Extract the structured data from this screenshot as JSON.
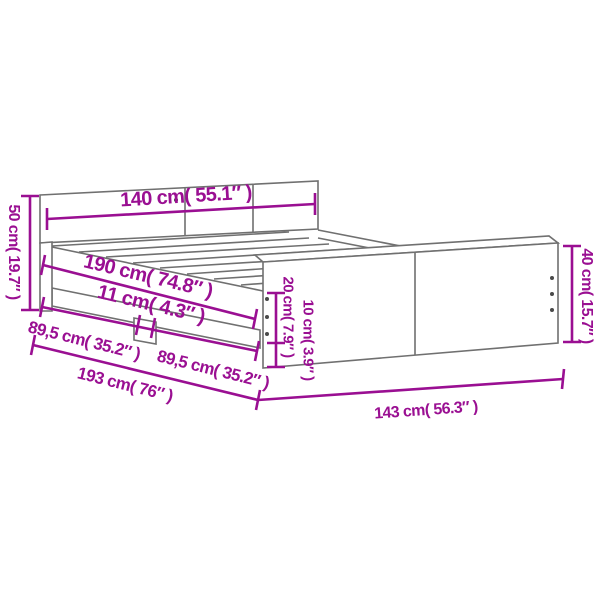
{
  "title": "Bed frame dimensions diagram",
  "colors": {
    "dimension_accent": "#9A0F92",
    "line_art": "#707070",
    "background": "#FFFFFF"
  },
  "diagram": {
    "kind": "furniture-dimension-drawing",
    "parts": [
      "headboard",
      "slatted-base",
      "side-rail",
      "center-leg",
      "footboard"
    ]
  },
  "dimensions": [
    {
      "id": "inner-width",
      "label": "140 cm( 55.1″ )",
      "cm": "140",
      "inches": "55.1"
    },
    {
      "id": "headboard-height",
      "label": "50 cm( 19.7″ )",
      "cm": "50",
      "inches": "19.7"
    },
    {
      "id": "inner-length",
      "label": "190 cm( 74.8″ )",
      "cm": "190",
      "inches": "74.8"
    },
    {
      "id": "center-leg-width",
      "label": "11 cm( 4.3″ )",
      "cm": "11",
      "inches": "4.3"
    },
    {
      "id": "half-length-left",
      "label": "89,5 cm( 35.2″ )",
      "cm": "89,5",
      "inches": "35.2"
    },
    {
      "id": "half-length-right",
      "label": "89,5 cm( 35.2″ )",
      "cm": "89,5",
      "inches": "35.2"
    },
    {
      "id": "total-length",
      "label": "193 cm( 76″ )",
      "cm": "193",
      "inches": "76"
    },
    {
      "id": "total-width",
      "label": "143 cm( 56.3″ )",
      "cm": "143",
      "inches": "56.3"
    },
    {
      "id": "footboard-height",
      "label": "40 cm( 15.7″ )",
      "cm": "40",
      "inches": "15.7"
    },
    {
      "id": "rail-top-height",
      "label": "20 cm( 7.9″ )",
      "cm": "20",
      "inches": "7.9"
    },
    {
      "id": "clearance-height",
      "label": "10 cm( 3.9″ )",
      "cm": "10",
      "inches": "3.9"
    }
  ]
}
